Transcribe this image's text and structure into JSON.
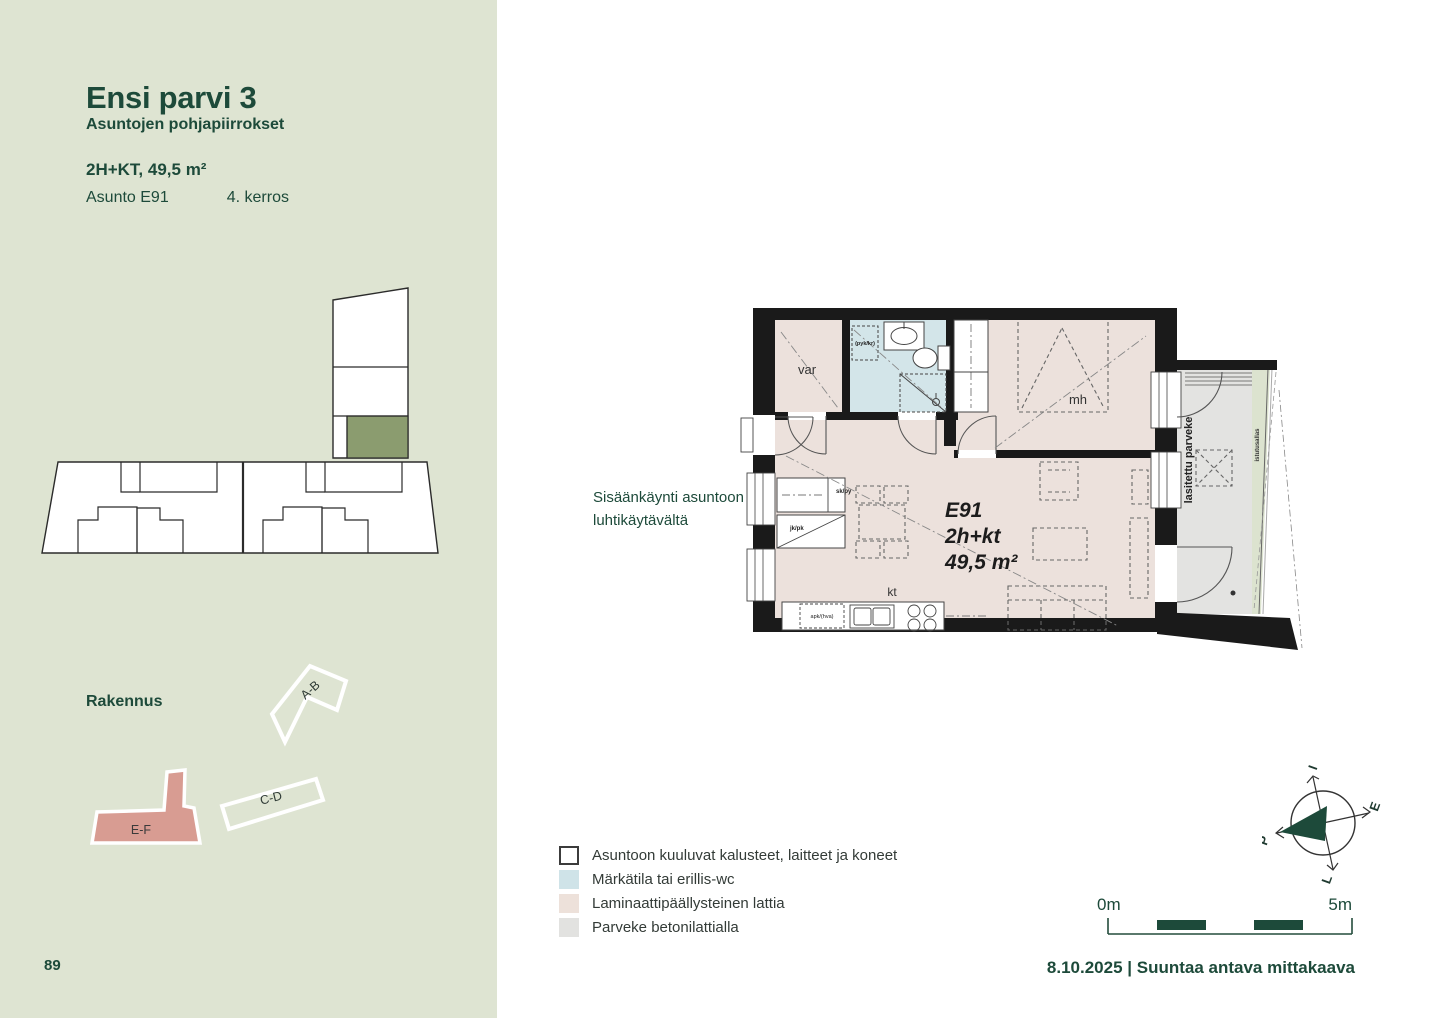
{
  "sidebar": {
    "title": "Ensi parvi 3",
    "subtitle": "Asuntojen pohjapiirrokset",
    "apartment_type": "2H+KT, 49,5 m²",
    "apartment_label": "Asunto E91",
    "floor_label": "4. kerros",
    "building_caption": "Rakennus",
    "building_names": {
      "ab": "A-B",
      "cd": "C-D",
      "ef": "E-F"
    },
    "page_number": "89"
  },
  "plan": {
    "entry_note": {
      "line1": "Sisäänkäynti asuntoon",
      "line2": "luhtikäytävältä"
    },
    "rooms": {
      "storage": "var",
      "bedroom": "mh",
      "kitchen": "kt"
    },
    "unit": {
      "id": "E91",
      "type": "2h+kt",
      "area": "49,5 m²"
    },
    "balcony": {
      "label": "lasitettu parveke",
      "planter": "istutusallas"
    },
    "appliances": {
      "washer_reservation": "(pyk/kr)",
      "cleaning_closet": "sk/py",
      "fridge_freezer": "jk/pk",
      "dishwasher_reservation": "apk/(hva)"
    }
  },
  "legend": {
    "items": [
      {
        "label": "Asuntoon kuuluvat kalusteet, laitteet ja koneet",
        "color": "#ffffff"
      },
      {
        "label": "Märkätila tai erillis-wc",
        "color": "#cfe3e8"
      },
      {
        "label": "Laminaattipäällysteinen lattia",
        "color": "#ede1da"
      },
      {
        "label": "Parveke betonilattialla",
        "color": "#e2e2e0"
      }
    ]
  },
  "scale_bar": {
    "start": "0m",
    "end": "5m"
  },
  "compass": {
    "north": "P",
    "east_letter": "I",
    "south_letter": "E",
    "west_letter": "L"
  },
  "footer": {
    "text": "8.10.2025 | Suuntaa antava mittakaava"
  },
  "colors": {
    "sidebar_bg": "#dee4d2",
    "dark_green": "#1d4a3a",
    "laminate": "#ece1dc",
    "wet_room": "#d3e5e9",
    "balcony_concrete": "#e3e3e1",
    "planter_green": "#dce3cf",
    "unit_highlight": "#8b9c6f",
    "building_ef": "#d89c92",
    "wall": "#1a1a1a"
  }
}
